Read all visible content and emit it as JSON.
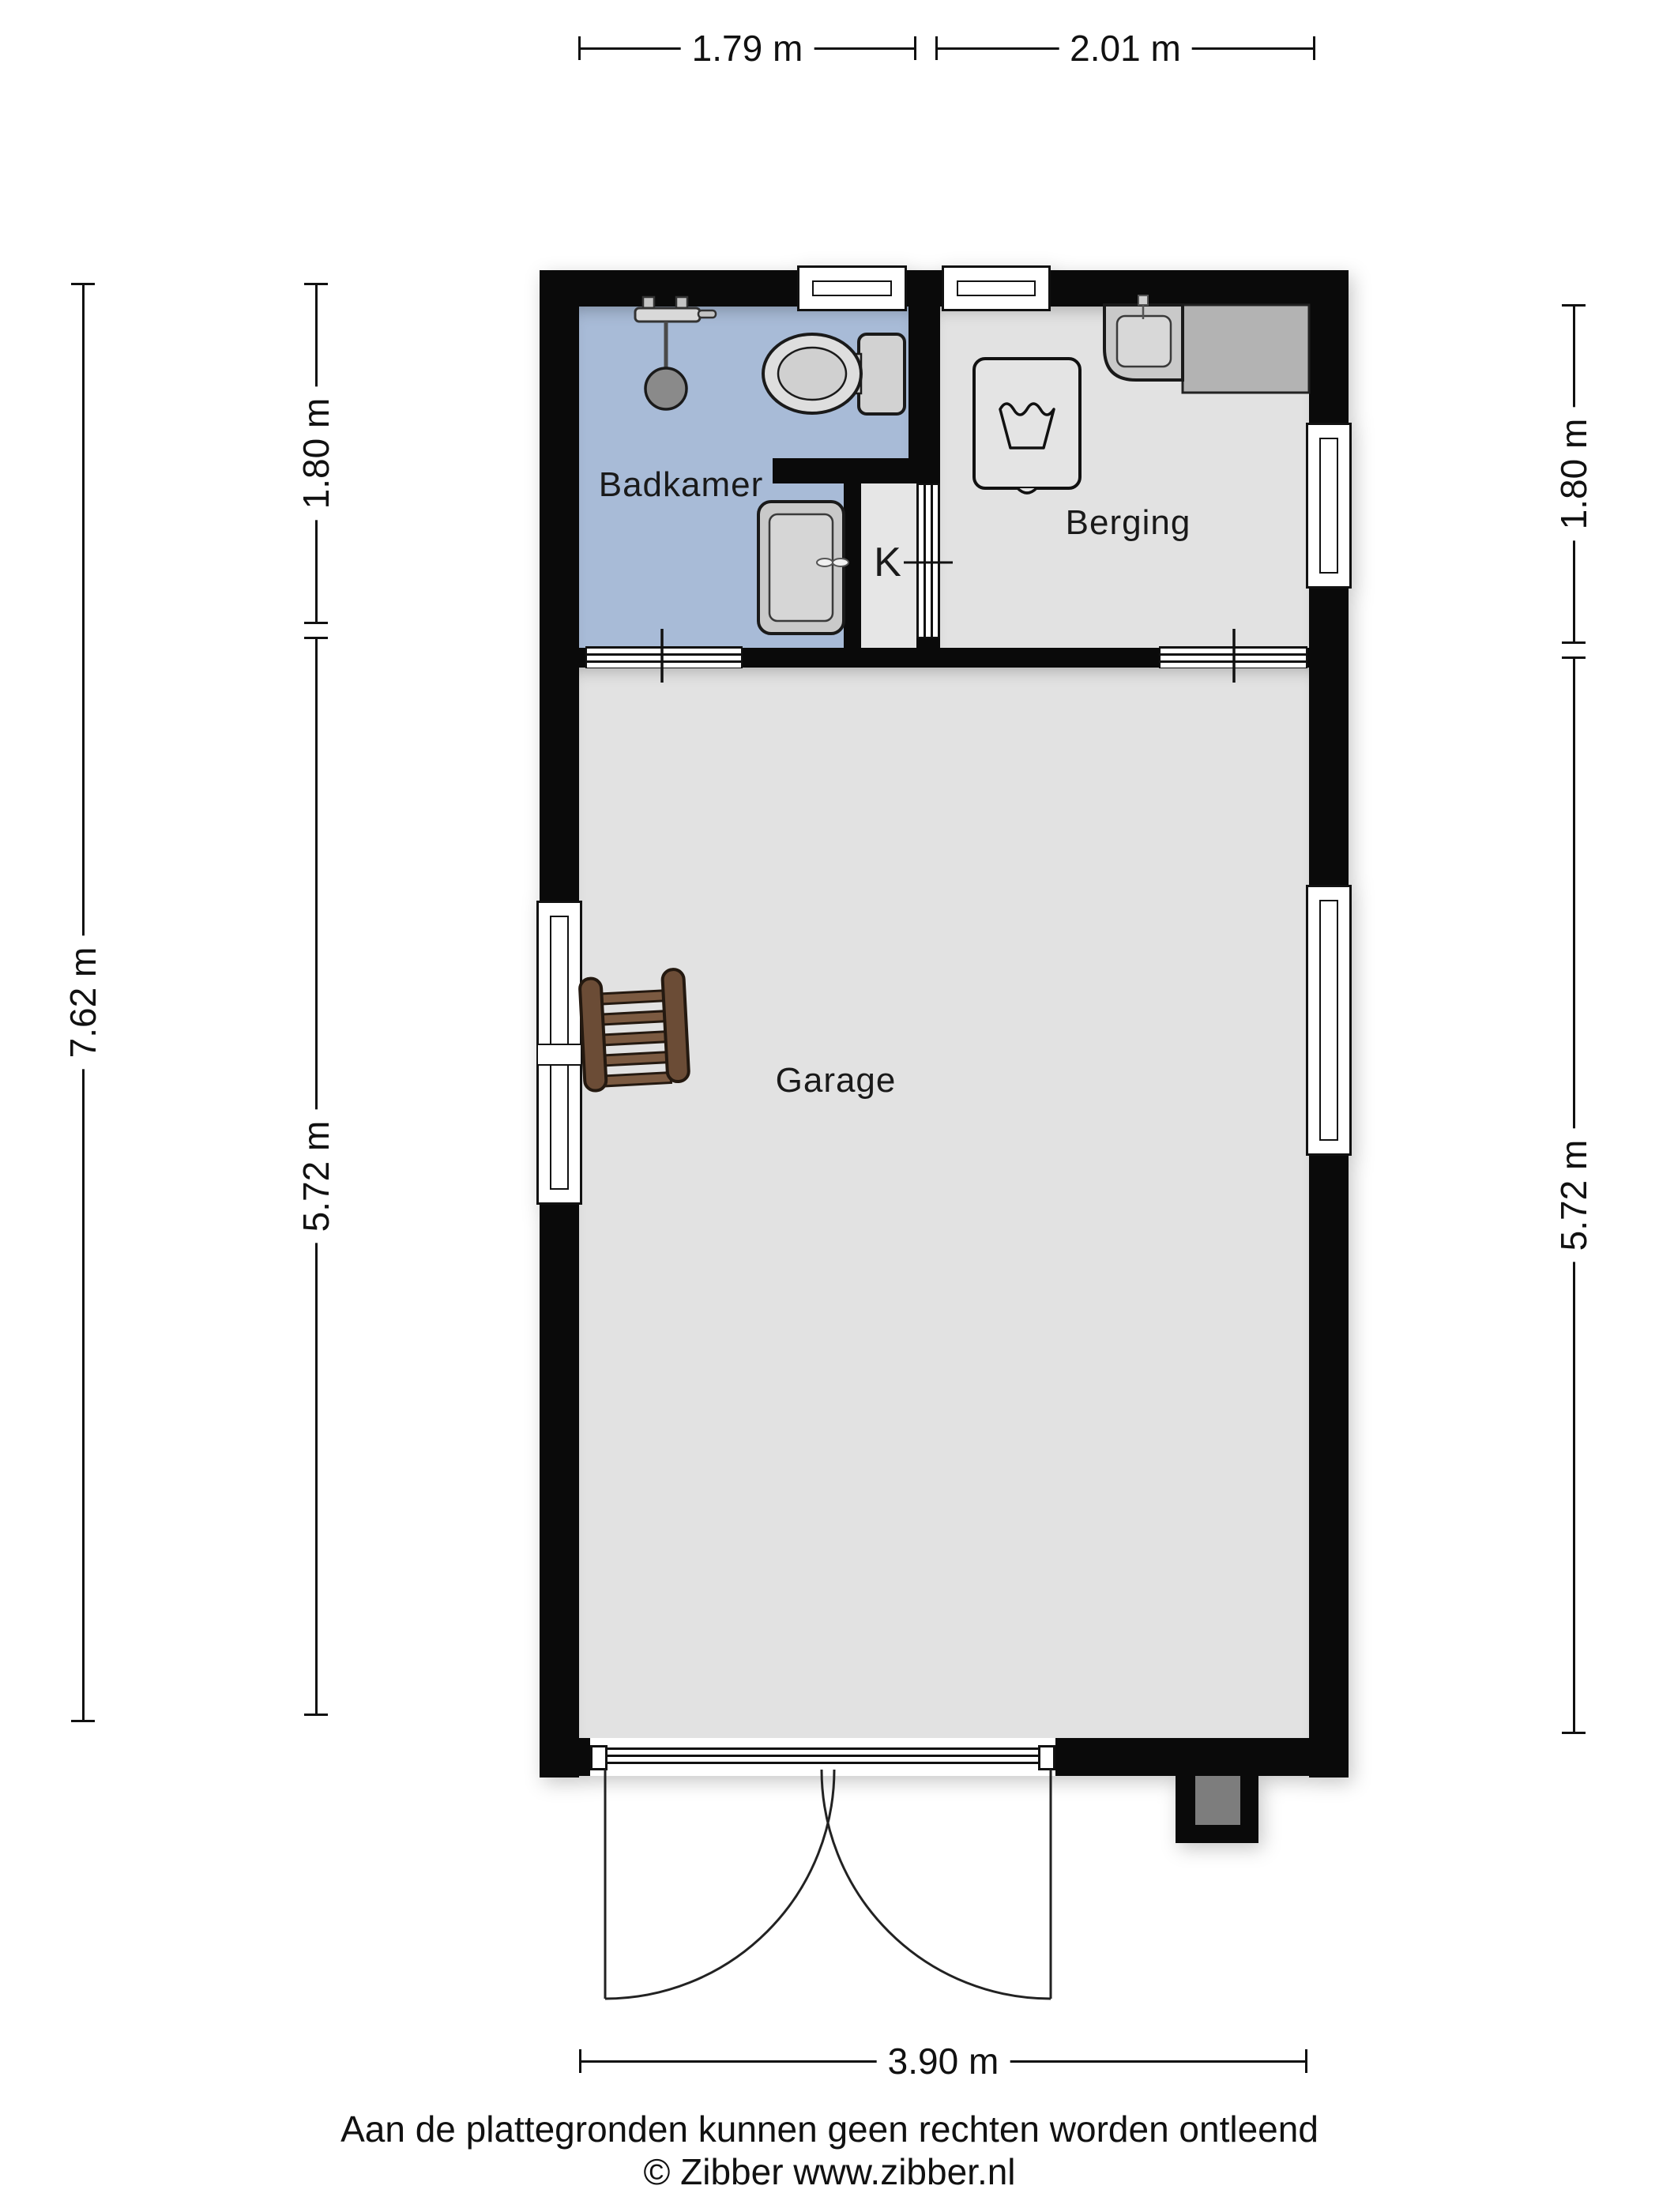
{
  "rooms": {
    "bathroom": "Badkamer",
    "storage": "Berging",
    "garage": "Garage",
    "closet": "K"
  },
  "dimensions": {
    "top_left": "1.79 m",
    "top_right": "2.01 m",
    "bottom": "3.90 m",
    "left_outer": "7.62 m",
    "left_upper": "1.80 m",
    "left_lower": "5.72 m",
    "right_upper": "1.80 m",
    "right_lower": "5.72 m"
  },
  "footer": {
    "disclaimer": "Aan de plattegronden kunnen geen rechten worden ontleend",
    "copyright": "© Zibber www.zibber.nl"
  },
  "colors": {
    "wall": "#0a0a0a",
    "bathroom_floor": "#a8bbd7",
    "room_floor": "#e2e2e2",
    "counter": "#b3b3b3",
    "fixture_fill": "#d6d6d6",
    "shower_head": "#8a8a8a",
    "ladder_wood": "#6b4c36"
  },
  "icons": {
    "shower": "shower-icon",
    "toilet": "toilet-icon",
    "bathroom_sink": "sink-icon",
    "storage_sink": "utility-sink-icon",
    "washer": "washing-machine-icon",
    "ladder": "ladder-icon"
  }
}
